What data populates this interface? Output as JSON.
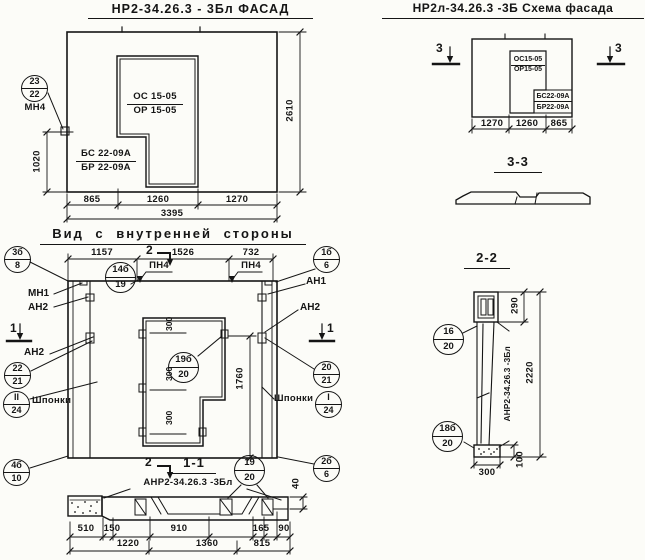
{
  "facade": {
    "title": "НР2-34.26.3 - 3Бл ФАСАД",
    "opening_mark_top": "ОС 15-05",
    "opening_mark_bottom": "ОР 15-05",
    "panel_mark_top": "БС 22-09А",
    "panel_mark_bottom": "БР 22-09А",
    "callout": {
      "top": "23",
      "bottom": "22"
    },
    "callout_label": "МН4",
    "dim_height_left": "1020",
    "dim_height_right": "2610",
    "dims_bottom": [
      "865",
      "1260",
      "1270"
    ],
    "dim_total": "3395"
  },
  "scheme": {
    "title": "НР2л-34.26.3 -3Б Схема фасада",
    "cut_mark": "3",
    "opening_mark_top": "ОС15-05",
    "opening_mark_bottom": "ОР15-05",
    "block_mark_top": "БС22-09А",
    "block_mark_bottom": "БР22-09А",
    "dims_bottom": [
      "1270",
      "1260",
      "865"
    ]
  },
  "section33": {
    "title": "3-3"
  },
  "inner": {
    "title": "Вид с внутренней стороны",
    "dims_top": [
      "1157",
      "1526",
      "732"
    ],
    "cut_mark2": "2",
    "cut_mark1": "1",
    "loop_label_1": "ПН4",
    "loop_label_2": "ПН4",
    "anchor_mn1": "МН1",
    "anchor_an2_left_top": "АН2",
    "anchor_an2_left": "АН2",
    "anchor_an1": "АН1",
    "anchor_an2_right": "АН2",
    "keys_label_left": "Шпонки",
    "keys_label_right": "Шпонки",
    "dim_300_1": "300",
    "dim_300_2": "300",
    "dim_300_3": "300",
    "dim_1760": "1760",
    "callouts": {
      "tl": {
        "top": "3б",
        "bottom": "8"
      },
      "tr": {
        "top": "1б",
        "bottom": "6"
      },
      "bl": {
        "top": "4б",
        "bottom": "10"
      },
      "br": {
        "top": "2б",
        "bottom": "6"
      },
      "top_mid": {
        "top": "14б",
        "bottom": "19"
      },
      "opening": {
        "top": "19б",
        "bottom": "20"
      },
      "left_mid": {
        "top": "22",
        "bottom": "21"
      },
      "left_keys": {
        "top": "II",
        "bottom": "24"
      },
      "right_mid": {
        "top": "20",
        "bottom": "21"
      },
      "right_keys": {
        "top": "I",
        "bottom": "24"
      }
    }
  },
  "section11": {
    "title": "1-1",
    "mark_label": "АНР2-34.26.3 -3Бл",
    "callout": {
      "top": "19",
      "bottom": "20"
    },
    "dim_40": "40",
    "dims_row1": [
      "510",
      "150",
      "910",
      "165",
      "90"
    ],
    "dims_row2": [
      "1220",
      "1360",
      "815"
    ]
  },
  "section22": {
    "title": "2-2",
    "mark_label": "АНР2-34.26.3 -3Бл",
    "callout_head": {
      "top": "16",
      "bottom": "20"
    },
    "callout_base": {
      "top": "18б",
      "bottom": "20"
    },
    "dim_290": "290",
    "dim_2220": "2220",
    "dim_100": "100",
    "dim_300": "300"
  },
  "colors": {
    "ink": "#151515",
    "paper": "#fcfcf8"
  }
}
